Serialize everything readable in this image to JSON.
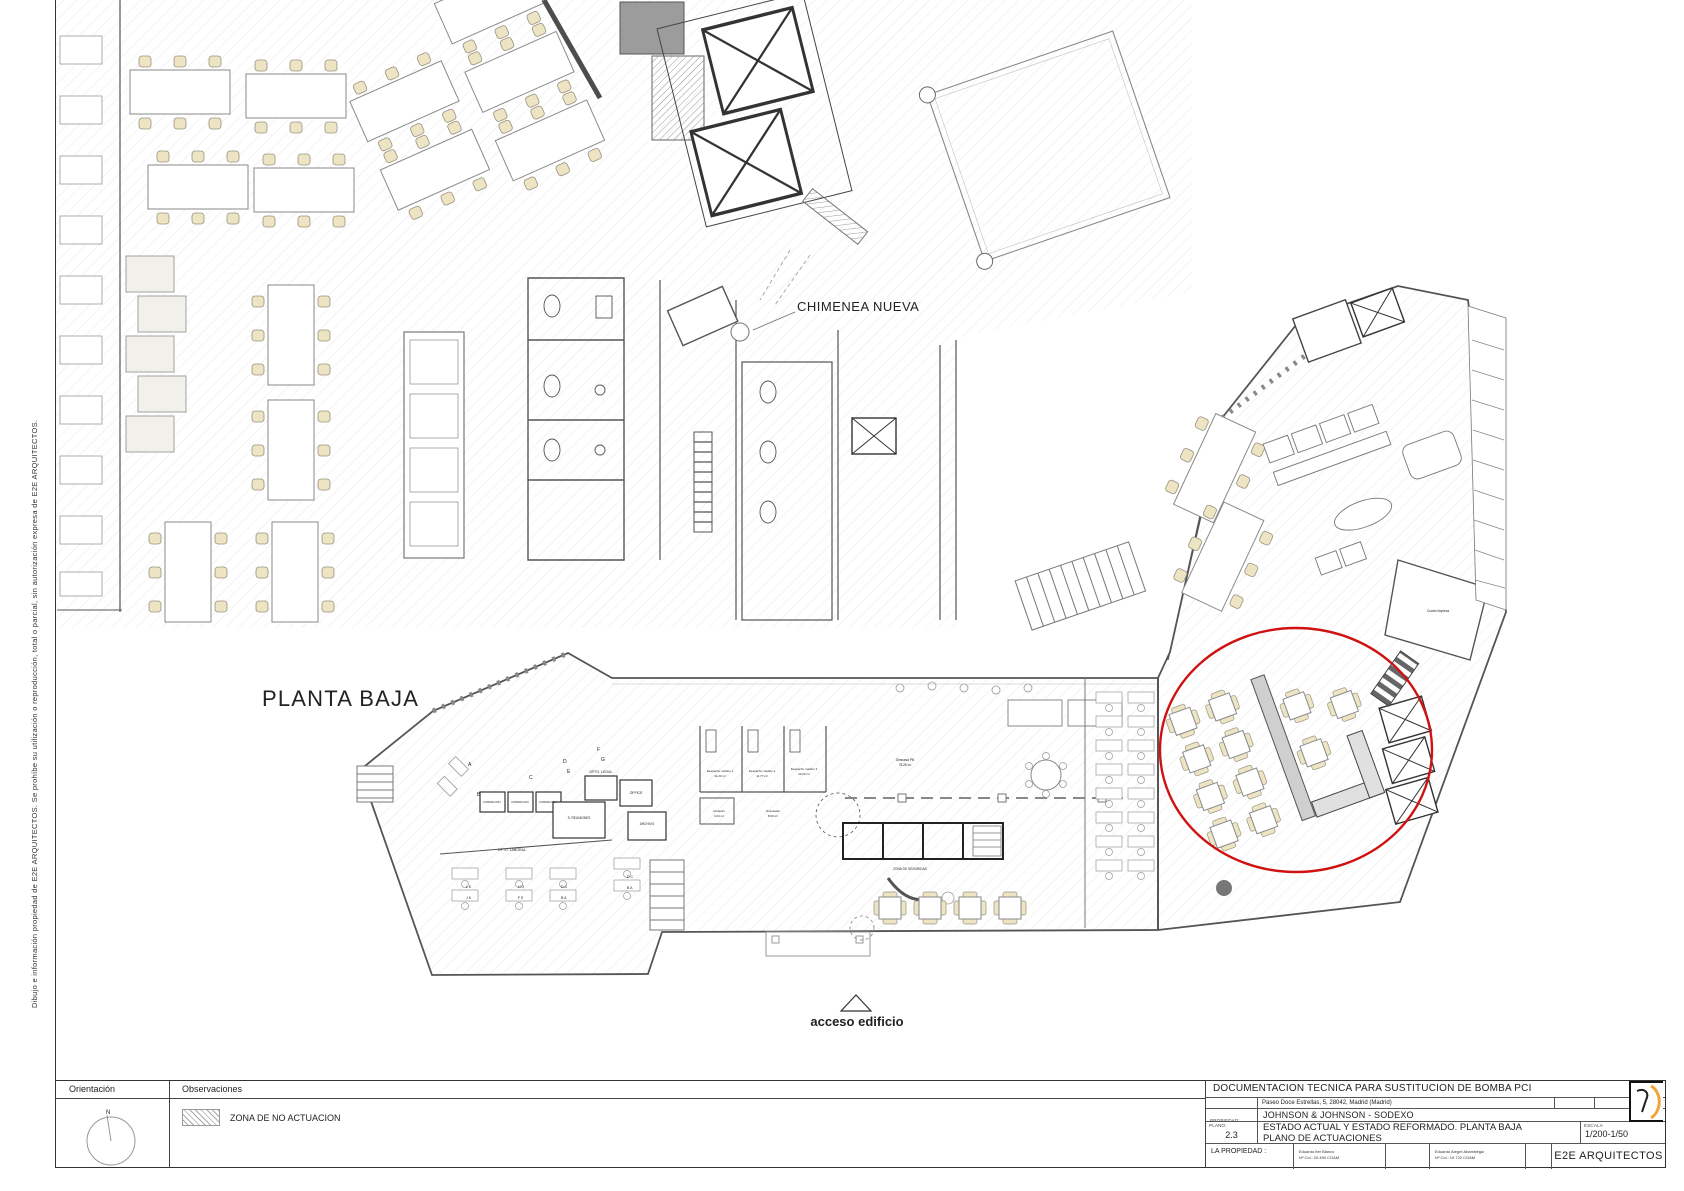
{
  "sheet": {
    "margin_note": "Dibujo e información propiedad de E2E ARQUITECTOS.  Se prohíbe su utilización o reproducción, total o parcial, sin autorización expresa de E2E ARQUITECTOS.",
    "colors": {
      "highlight_red": "#cf1212",
      "chair_cream": "#ece4c3",
      "logo_orange": "#f2a33c"
    }
  },
  "plan": {
    "title": "PLANTA BAJA",
    "chimenea_label": "CHIMENEA NUEVA",
    "acceso_label": "acceso edificio",
    "rooms": {
      "dpto_legal": "DPTO. LEGAL",
      "s_reuniones": "S. REUNIONES",
      "archivo": "ARCHIVO",
      "formacion": "FORMACION",
      "office": "OFFICE",
      "dpto_laboral": "DPTO. LABORAL",
      "zona_seguridad": "ZONA DE SEGURIDAD",
      "despacho1": "Despacho médico 1",
      "despacho1_area": "11.20 m²",
      "despacho2": "Despacho médico 2",
      "despacho2_area": "11.77 m²",
      "despacho3": "Despacho médico 3",
      "despacho3_area": "10.24 m²",
      "almacen": "Almacén",
      "almacen_area": "4.04 m²",
      "orientador": "Orientador",
      "orientador_area": "8.60 m²",
      "gimnasio": "Gimnasio PB",
      "gimnasio_area": "78.26 m²",
      "cuarto_limpieza": "Cuarto limpieza"
    },
    "zone_letters": [
      "A",
      "B",
      "C",
      "D",
      "E",
      "F",
      "G"
    ],
    "desk_letters": [
      "L K",
      "J K",
      "H G",
      "F E",
      "D C",
      "B A"
    ]
  },
  "orientation_panel": {
    "title": "Orientación",
    "north": "N"
  },
  "observations_panel": {
    "title": "Observaciones",
    "legend_label": "ZONA DE NO ACTUACION"
  },
  "title_block": {
    "document_title": "DOCUMENTACION TECNICA PARA SUSTITUCION DE BOMBA PCI",
    "situacion_label": "SITUACION:",
    "situacion_value": "Paseo Doce Estrellas, 5, 28042, Madrid (Madrid)",
    "fase_label": "FASE:",
    "fase_value": "",
    "propiedad_label": "PROPIEDAD:",
    "propiedad_value": "JOHNSON & JOHNSON - SODEXO",
    "plano_label": "PLANO:",
    "plano_number": "2.3",
    "plano_title_line1": "ESTADO ACTUAL Y ESTADO REFORMADO. PLANTA BAJA",
    "plano_title_line2": "PLANO DE ACTUACIONES",
    "escala_label": "ESCALA",
    "escala_value": "1/200-1/50",
    "la_propiedad_label": "LA PROPIEDAD :",
    "architects": [
      {
        "name": "Eduardo Iter Blanco",
        "college": "Nº Col.: 20.494 COAM"
      },
      {
        "name": "Eduardo Alegre Abarrátegui",
        "college": "Nº Col.: 19.722 COAM"
      }
    ],
    "firm": "E2E ARQUITECTOS"
  }
}
